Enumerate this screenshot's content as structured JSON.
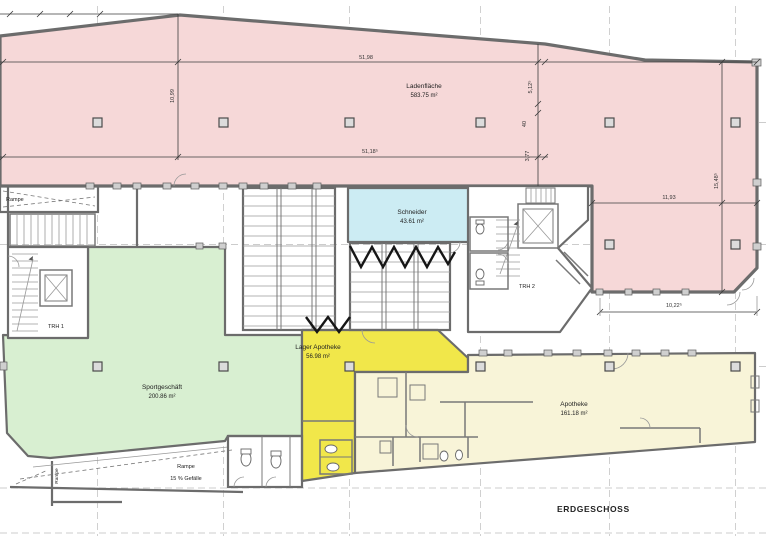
{
  "floor_plan": {
    "floor_label": "ERDGESCHOSS",
    "rooms": {
      "ladenflaeche": {
        "name": "Ladenfläche",
        "area": "583.75 m²"
      },
      "schneider": {
        "name": "Schneider",
        "area": "43.61 m²"
      },
      "sportgeschaeft": {
        "name": "Sportgeschäft",
        "area": "200.86 m²"
      },
      "lager_apotheke": {
        "name": "Lager Apotheke",
        "area": "56.98 m²"
      },
      "apotheke": {
        "name": "Apotheke",
        "area": "161.18 m²"
      }
    },
    "stairwells": {
      "trh1": "TRH 1",
      "trh2": "TRH 2"
    },
    "ramps": {
      "upper": "Rampe",
      "lower": "Rampe",
      "lower_slope": "15 % Gefälle",
      "side": "Rampe"
    },
    "dimensions": {
      "top_width": "51,98",
      "inner_width": "51,18⁵",
      "left_height": "10,99",
      "right_chain_1": "5,12⁵",
      "right_chain_2": "40",
      "right_chain_3": "3,77",
      "lobe_width": "11,93",
      "lobe_height": "15,48⁵",
      "bottom_width": "10,22⁵"
    },
    "colors": {
      "retail_pink": "#f6d8d8",
      "schneider_cyan": "#ccecf3",
      "sport_green": "#d8efd1",
      "lager_yellow": "#f1e74a",
      "apotheke_cream": "#f8f4d8",
      "wc_cyan": "#cfeef4",
      "wall_grey": "#6f6f6f"
    }
  }
}
